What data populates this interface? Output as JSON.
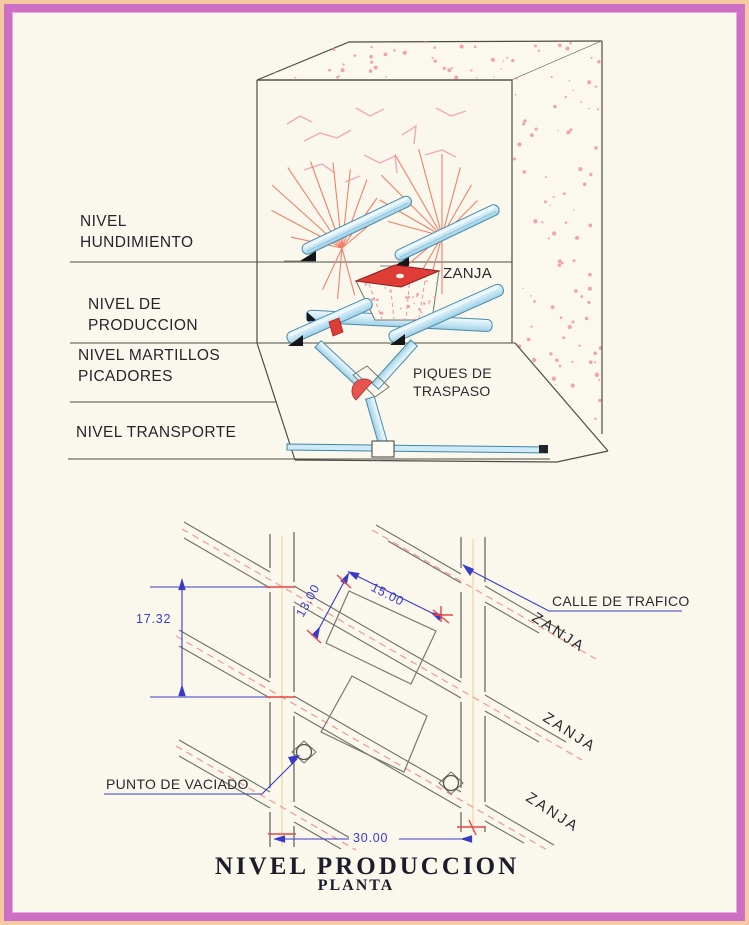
{
  "colors": {
    "frame_outer": "#f5c9a2",
    "frame_band": "#ce6fc6",
    "paper": "#faf8ec",
    "line_gray": "#4c4c48",
    "wall_gray": "#6e6e66",
    "text_dark": "#25252d",
    "tube_fill": "#cfeaf6",
    "tube_edge": "#4a8aa8",
    "red": "#e03c36",
    "pink_speckle": "#f2a0b4",
    "pink_dash": "#f09890",
    "ray_salmon": "#f08068",
    "dim_blue": "#3a3ac8",
    "tick_red": "#e84545",
    "street_centerline": "#f0dca6"
  },
  "iso": {
    "level_labels": [
      {
        "l1": "NIVEL",
        "l2": "HUNDIMIENTO"
      },
      {
        "l1": "NIVEL DE",
        "l2": "PRODUCCION"
      },
      {
        "l1": "NIVEL MARTILLOS",
        "l2": "PICADORES"
      },
      {
        "l1": "NIVEL TRANSPORTE",
        "l2": ""
      }
    ],
    "zanja_label": "ZANJA",
    "piques_label_1": "PIQUES DE",
    "piques_label_2": "TRASPASO"
  },
  "plan": {
    "calle_label": "CALLE DE TRAFICO",
    "zanja_labels": [
      "ZANJA",
      "ZANJA",
      "ZANJA"
    ],
    "punto_label": "PUNTO DE VACIADO",
    "dims": {
      "vertical_spacing": "17.32",
      "zanja_width": "13.00",
      "zanja_length": "15.00",
      "street_spacing": "30.00"
    },
    "title": "NIVEL PRODUCCION",
    "subtitle": "PLANTA"
  }
}
